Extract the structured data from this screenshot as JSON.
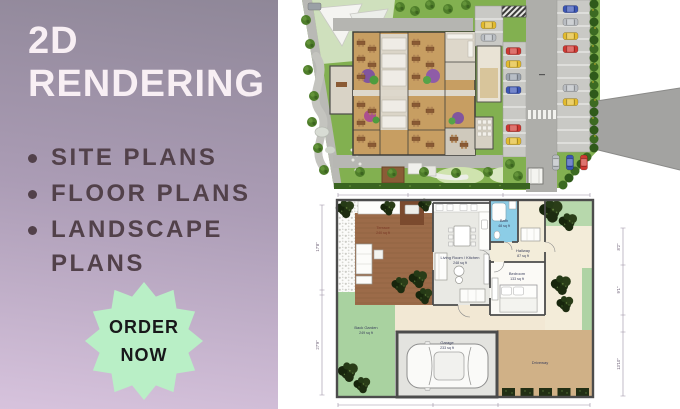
{
  "panel": {
    "title_line1": "2D",
    "title_line2": "RENDERING",
    "bullet_items": [
      "SITE PLANS",
      "FLOOR PLANS",
      "LANDSCAPE PLANS"
    ],
    "badge": {
      "line1": "ORDER",
      "line2": "NOW"
    },
    "colors": {
      "gradient_top": "#8f8798",
      "gradient_bottom": "#d7c3dd",
      "title_text": "#f8eff4",
      "bullet_text": "#52414a",
      "badge_bg": "#b9efc6",
      "badge_text": "#18181a"
    }
  },
  "floor_plan": {
    "rooms": [
      {
        "name": "Terrace",
        "area": "240 sq ft"
      },
      {
        "name": "Living Room / Kitchen",
        "area": "248 sq ft"
      },
      {
        "name": "Bath",
        "area": "48 sq ft"
      },
      {
        "name": "Hallway",
        "area": "87 sq ft"
      },
      {
        "name": "Bedroom",
        "area": "133 sq ft"
      },
      {
        "name": "Back Garden",
        "area": "249 sq ft"
      },
      {
        "name": "Garage",
        "area": "233 sq ft"
      },
      {
        "name": "Driveway",
        "area": ""
      }
    ],
    "dimensions": {
      "left_upper": "17'8\"",
      "left_lower": "27'9\"",
      "right_upper": "8'2\"",
      "right_middle": "9'1\"",
      "right_lower": "13'10\""
    }
  }
}
